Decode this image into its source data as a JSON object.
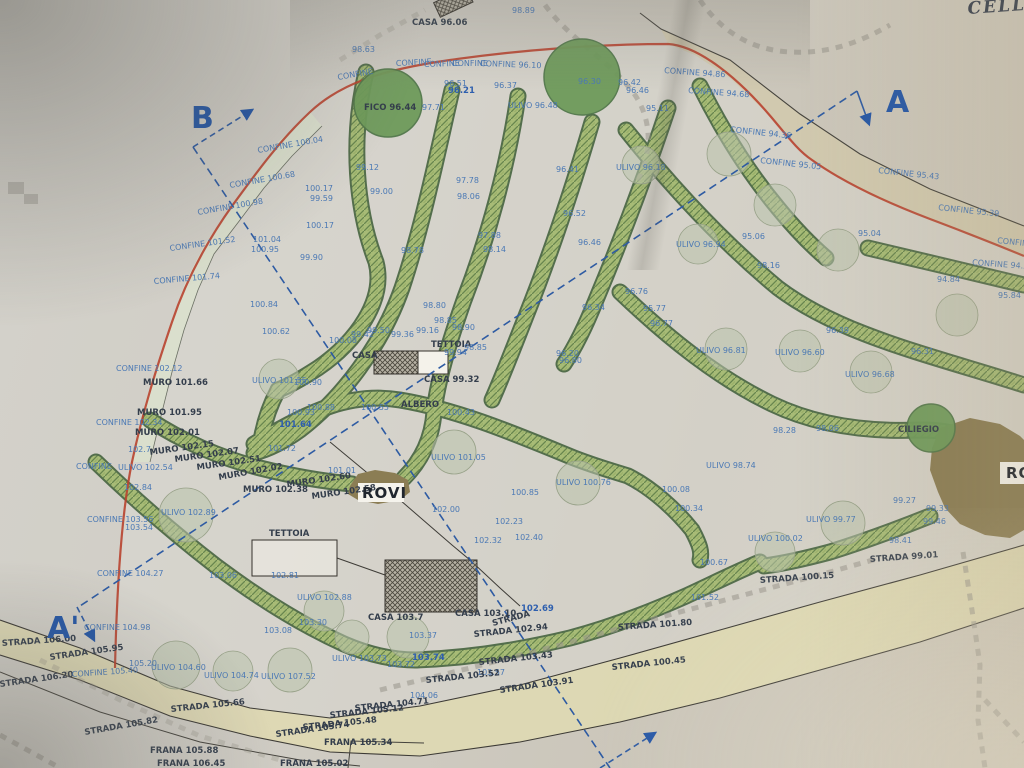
{
  "map": {
    "handwritten_note": "CELLO",
    "colors": {
      "boundary_red": "#b8432f",
      "label_blue": "#4b79b5",
      "vegetation_green": "#a7bb76",
      "road_beige": "#dfd9b2",
      "tree_dark_green": "#6e9a5a",
      "olive_sage": "#b9c3ab",
      "rovi_brown": "#8b7d54",
      "section_blue": "#2456a6"
    },
    "section_markers": [
      "A",
      "A'",
      "B"
    ],
    "labels": [
      [
        "98.89",
        512,
        13,
        0,
        "b"
      ],
      [
        "CASA 96.06",
        412,
        25,
        0,
        "d"
      ],
      [
        "98.63",
        352,
        52,
        0,
        "b"
      ],
      [
        "CONFINE",
        338,
        80,
        -10,
        "b"
      ],
      [
        "CONFINE",
        396,
        66,
        -3,
        "b"
      ],
      [
        "CONFINE",
        424,
        67,
        -2,
        "b"
      ],
      [
        "CONFINE",
        452,
        66,
        0,
        "b"
      ],
      [
        "CONFINE 96.10",
        480,
        66,
        2,
        "b"
      ],
      [
        "CONFINE 94.86",
        664,
        73,
        4,
        "b"
      ],
      [
        "CONFINE 94.68",
        688,
        93,
        4,
        "b"
      ],
      [
        "CONFINE 94.36",
        730,
        132,
        6,
        "b"
      ],
      [
        "CONFINE 95.05",
        760,
        163,
        6,
        "b"
      ],
      [
        "CONFINE 95.43",
        878,
        173,
        6,
        "b"
      ],
      [
        "CONFINE 95.39",
        938,
        210,
        6,
        "b"
      ],
      [
        "CONFINE",
        997,
        243,
        6,
        "b"
      ],
      [
        "CONFINE 94.57",
        972,
        265,
        4,
        "b"
      ],
      [
        "95.04",
        858,
        236,
        0,
        "b"
      ],
      [
        "94.84",
        937,
        282,
        0,
        "b"
      ],
      [
        "95.84",
        998,
        298,
        0,
        "b"
      ],
      [
        "FICO 96.44",
        364,
        110,
        0,
        "d"
      ],
      [
        "96.30",
        578,
        84,
        0,
        "b"
      ],
      [
        "96.42",
        618,
        85,
        0,
        "b"
      ],
      [
        "96.46",
        626,
        93,
        0,
        "b"
      ],
      [
        "95.11",
        646,
        111,
        0,
        "b"
      ],
      [
        "96.51",
        444,
        86,
        0,
        "b"
      ],
      [
        "96.21",
        448,
        93,
        0,
        "bb"
      ],
      [
        "96.37",
        494,
        88,
        0,
        "b"
      ],
      [
        "97.71",
        422,
        110,
        0,
        "b"
      ],
      [
        "ULIVO 96.48",
        508,
        108,
        0,
        "b"
      ],
      [
        "ULIVO 96.18",
        616,
        170,
        0,
        "b"
      ],
      [
        "96.41",
        556,
        172,
        0,
        "b"
      ],
      [
        "99.12",
        356,
        170,
        0,
        "b"
      ],
      [
        "99.00",
        370,
        194,
        0,
        "b"
      ],
      [
        "CONFINE 100.04",
        258,
        153,
        -10,
        "b"
      ],
      [
        "CONFINE 100.68",
        230,
        188,
        -10,
        "b"
      ],
      [
        "CONFINE 100.98",
        198,
        215,
        -10,
        "b"
      ],
      [
        "CONFINE 101.52",
        170,
        251,
        -8,
        "b"
      ],
      [
        "CONFINE 101.74",
        154,
        284,
        -5,
        "b"
      ],
      [
        "100.17",
        305,
        191,
        0,
        "b"
      ],
      [
        "99.59",
        310,
        201,
        0,
        "b"
      ],
      [
        "100.17",
        306,
        228,
        0,
        "b"
      ],
      [
        "101.04",
        253,
        242,
        0,
        "b"
      ],
      [
        "100.95",
        251,
        252,
        0,
        "b"
      ],
      [
        "99.90",
        300,
        260,
        0,
        "b"
      ],
      [
        "100.84",
        250,
        307,
        0,
        "b"
      ],
      [
        "100.62",
        262,
        334,
        0,
        "b"
      ],
      [
        "96.52",
        563,
        216,
        0,
        "b"
      ],
      [
        "96.46",
        578,
        245,
        0,
        "b"
      ],
      [
        "97.78",
        456,
        183,
        0,
        "b"
      ],
      [
        "98.06",
        457,
        199,
        0,
        "b"
      ],
      [
        "97.88",
        478,
        238,
        0,
        "b"
      ],
      [
        "98.14",
        483,
        252,
        0,
        "b"
      ],
      [
        "98.78",
        401,
        253,
        0,
        "b"
      ],
      [
        "96.76",
        625,
        294,
        0,
        "b"
      ],
      [
        "95.77",
        643,
        311,
        0,
        "b"
      ],
      [
        "96.77",
        650,
        326,
        0,
        "b"
      ],
      [
        "96.34",
        582,
        310,
        0,
        "b"
      ],
      [
        "96.20",
        556,
        356,
        0,
        "b"
      ],
      [
        "96.80",
        559,
        363,
        0,
        "b"
      ],
      [
        "96.39",
        826,
        333,
        0,
        "b"
      ],
      [
        "96.31",
        911,
        354,
        0,
        "b"
      ],
      [
        "ULIVO 96.94",
        676,
        247,
        0,
        "b"
      ],
      [
        "ULIVO 96.81",
        696,
        353,
        0,
        "b"
      ],
      [
        "ULIVO 96.60",
        775,
        355,
        0,
        "b"
      ],
      [
        "ULIVO 96.68",
        845,
        377,
        0,
        "b"
      ],
      [
        "95.06",
        742,
        239,
        0,
        "b"
      ],
      [
        "98.16",
        757,
        268,
        0,
        "b"
      ],
      [
        "CONFINE 102.12",
        116,
        371,
        0,
        "b"
      ],
      [
        "MURO 101.66",
        143,
        385,
        0,
        "d"
      ],
      [
        "MURO 101.95",
        137,
        415,
        0,
        "d"
      ],
      [
        "CONFINE 102.34",
        96,
        425,
        0,
        "b"
      ],
      [
        "MURO 102.01",
        135,
        435,
        0,
        "d"
      ],
      [
        "102.7",
        128,
        452,
        0,
        "b"
      ],
      [
        "MURO 102.15",
        150,
        455,
        -8,
        "d"
      ],
      [
        "MURO 102.07",
        175,
        462,
        -8,
        "d"
      ],
      [
        "MURO 102.51",
        197,
        470,
        -8,
        "d"
      ],
      [
        "MURO 102.02",
        219,
        480,
        -10,
        "d"
      ],
      [
        "MURO 102.38",
        243,
        492,
        0,
        "d"
      ],
      [
        "MURO 102.60",
        287,
        487,
        -8,
        "d"
      ],
      [
        "MURO 102.58",
        312,
        499,
        -8,
        "d"
      ],
      [
        "101.72",
        268,
        451,
        0,
        "b"
      ],
      [
        "101.01",
        328,
        473,
        0,
        "b"
      ],
      [
        "CONFINE",
        76,
        469,
        0,
        "b"
      ],
      [
        "ULIVO 102.54",
        118,
        470,
        0,
        "b"
      ],
      [
        "102.84",
        124,
        490,
        0,
        "b"
      ],
      [
        "CONFINE 103.56",
        87,
        522,
        0,
        "b"
      ],
      [
        "103.54",
        125,
        530,
        0,
        "b"
      ],
      [
        "ULIVO 102.89",
        161,
        515,
        0,
        "b"
      ],
      [
        "ULIVO 101.55",
        252,
        383,
        0,
        "b"
      ],
      [
        "100.90",
        294,
        385,
        0,
        "b"
      ],
      [
        "100.88",
        307,
        410,
        0,
        "b"
      ],
      [
        "100.93",
        287,
        415,
        0,
        "b"
      ],
      [
        "101.64",
        279,
        427,
        0,
        "bb"
      ],
      [
        "CASA",
        352,
        358,
        0,
        "d"
      ],
      [
        "99.94",
        444,
        355,
        0,
        "b"
      ],
      [
        "TETTOIA",
        431,
        347,
        0,
        "d"
      ],
      [
        "98.85",
        464,
        350,
        0,
        "b"
      ],
      [
        "CASA 99.32",
        424,
        382,
        0,
        "d"
      ],
      [
        "ALBERO",
        401,
        407,
        0,
        "d"
      ],
      [
        "100.55",
        361,
        410,
        0,
        "b"
      ],
      [
        "100.43",
        447,
        415,
        0,
        "b"
      ],
      [
        "100.08",
        329,
        343,
        0,
        "b"
      ],
      [
        "99.50",
        367,
        333,
        0,
        "b"
      ],
      [
        "99.42",
        351,
        337,
        0,
        "b"
      ],
      [
        "99.36",
        391,
        337,
        0,
        "b"
      ],
      [
        "99.16",
        416,
        333,
        0,
        "b"
      ],
      [
        "98.80",
        423,
        308,
        0,
        "b"
      ],
      [
        "98.85",
        434,
        323,
        0,
        "b"
      ],
      [
        "98.90",
        452,
        330,
        0,
        "b"
      ],
      [
        "ULIVO 101.05",
        431,
        460,
        0,
        "b"
      ],
      [
        "ULIVO 100.76",
        556,
        485,
        0,
        "b"
      ],
      [
        "100.85",
        511,
        495,
        0,
        "b"
      ],
      [
        "102.00",
        432,
        512,
        0,
        "b"
      ],
      [
        "102.23",
        495,
        524,
        0,
        "b"
      ],
      [
        "102.40",
        515,
        540,
        0,
        "b"
      ],
      [
        "102.32",
        474,
        543,
        0,
        "b"
      ],
      [
        "100.08",
        662,
        492,
        0,
        "b"
      ],
      [
        "100.34",
        675,
        511,
        0,
        "b"
      ],
      [
        "ULIVO 98.74",
        706,
        468,
        0,
        "b"
      ],
      [
        "ROVI",
        362,
        498,
        0,
        "rovi"
      ],
      [
        "ROVI",
        1006,
        478,
        0,
        "rovi"
      ],
      [
        "ULIVO 100.02",
        748,
        541,
        0,
        "b"
      ],
      [
        "STRADA 100.15",
        760,
        583,
        -4,
        "d"
      ],
      [
        "STRADA 99.01",
        870,
        562,
        -4,
        "d"
      ],
      [
        "STRADA 101.80",
        618,
        630,
        -4,
        "d"
      ],
      [
        "STRADA 100.45",
        612,
        670,
        -6,
        "d"
      ],
      [
        "100.67",
        700,
        565,
        0,
        "b"
      ],
      [
        "101.52",
        691,
        600,
        0,
        "b"
      ],
      [
        "CILIEGIO",
        898,
        432,
        0,
        "d"
      ],
      [
        "99.27",
        893,
        503,
        0,
        "b"
      ],
      [
        "99.33",
        926,
        511,
        0,
        "b"
      ],
      [
        "99.46",
        923,
        524,
        0,
        "b"
      ],
      [
        "98.41",
        889,
        543,
        0,
        "b"
      ],
      [
        "ULIVO 99.77",
        806,
        522,
        0,
        "b"
      ],
      [
        "98.28",
        773,
        433,
        0,
        "b"
      ],
      [
        "98.06",
        816,
        431,
        0,
        "b"
      ],
      [
        "TETTOIA",
        269,
        536,
        0,
        "d"
      ],
      [
        "102.81",
        271,
        578,
        0,
        "b"
      ],
      [
        "103.06",
        209,
        578,
        0,
        "b"
      ],
      [
        "CONFINE 104.27",
        97,
        576,
        0,
        "b"
      ],
      [
        "CONFINE 104.98",
        84,
        630,
        0,
        "b"
      ],
      [
        "ULIVO 102.88",
        297,
        600,
        0,
        "b"
      ],
      [
        "103.30",
        299,
        625,
        0,
        "b"
      ],
      [
        "103.08",
        264,
        633,
        0,
        "b"
      ],
      [
        "CASA 103.7",
        368,
        620,
        0,
        "d"
      ],
      [
        "103.37",
        409,
        638,
        0,
        "b"
      ],
      [
        "CASA 103.10",
        455,
        616,
        0,
        "d"
      ],
      [
        "102.69",
        521,
        611,
        0,
        "bb"
      ],
      [
        "STRADA 102.94",
        474,
        637,
        -6,
        "d"
      ],
      [
        "STRADA",
        493,
        626,
        -15,
        "d"
      ],
      [
        "STRADA 103.43",
        479,
        665,
        -6,
        "d"
      ],
      [
        "103.57",
        477,
        675,
        0,
        "b"
      ],
      [
        "STRADA 103.52",
        426,
        683,
        -6,
        "d"
      ],
      [
        "STRADA 103.91",
        500,
        693,
        -8,
        "d"
      ],
      [
        "104.06",
        410,
        698,
        0,
        "b"
      ],
      [
        "STRADA 104.71",
        355,
        711,
        -6,
        "d"
      ],
      [
        "STRADA 105.12",
        330,
        718,
        -6,
        "d"
      ],
      [
        "STRADA 105.48",
        303,
        730,
        -6,
        "d"
      ],
      [
        "STRADA 105.74",
        276,
        737,
        -8,
        "d"
      ],
      [
        "FRANA 105.34",
        324,
        745,
        0,
        "d"
      ],
      [
        "FRANA 105.88",
        150,
        753,
        0,
        "d"
      ],
      [
        "FRANA 106.45",
        157,
        766,
        0,
        "d"
      ],
      [
        "FRANA 105.02",
        280,
        766,
        0,
        "d"
      ],
      [
        "STRADA 105.82",
        85,
        735,
        -10,
        "d"
      ],
      [
        "STRADA 105.66",
        171,
        712,
        -6,
        "d"
      ],
      [
        "STRADA 106.00",
        2,
        646,
        -4,
        "d"
      ],
      [
        "STRADA 105.95",
        50,
        660,
        -8,
        "d"
      ],
      [
        "STRADA 106.20",
        0,
        687,
        -8,
        "d"
      ],
      [
        "CONFINE 105.40",
        72,
        677,
        -4,
        "b"
      ],
      [
        "105.20",
        129,
        666,
        0,
        "b"
      ],
      [
        "ULIVO 104.60",
        151,
        670,
        0,
        "b"
      ],
      [
        "ULIVO 104.74",
        204,
        678,
        0,
        "b"
      ],
      [
        "ULIVO 107.52",
        261,
        679,
        0,
        "b"
      ],
      [
        "ULIVO 103.73",
        332,
        661,
        0,
        "b"
      ],
      [
        "103.72",
        387,
        667,
        0,
        "b"
      ],
      [
        "103.74",
        412,
        660,
        0,
        "bb"
      ],
      [
        "B",
        191,
        128,
        0,
        "big"
      ],
      [
        "A",
        886,
        112,
        0,
        "big"
      ],
      [
        "A'",
        47,
        638,
        0,
        "big"
      ],
      [
        "CELLO",
        968,
        14,
        -4,
        "hand"
      ]
    ]
  }
}
